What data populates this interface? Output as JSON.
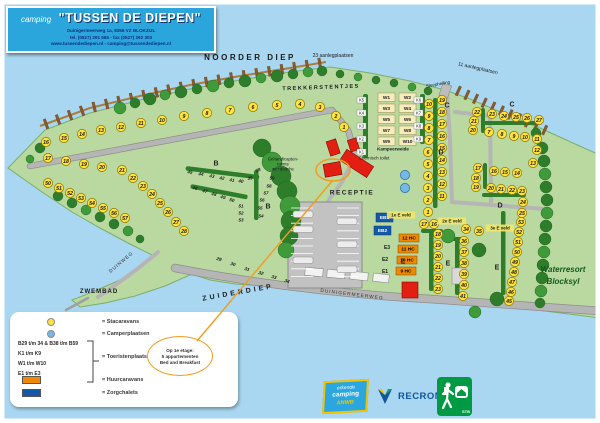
{
  "title": {
    "prefix": "camping",
    "name": "\"TUSSEN DE DIEPEN\"",
    "addr1": "Duinigermeerweg 1a, 8356 VZ BLOKZIJL",
    "addr2": "tel. (0527) 291 565 - fax (0527) 292 303",
    "addr3": "www.tussendediepen.nl - camping@tussendediepen.nl"
  },
  "legend": {
    "stacaravans": "= Stacaravans",
    "camperplaatsen": "= Camperplaatsen",
    "codes": [
      "B29 t/m 34 & B38 t/m B59",
      "K1 t/m K9",
      "W1 t/m W10",
      "E1 t/m E3"
    ],
    "toeristenplaatsen": "= Toeristenplaatsen",
    "huurcaravans": "= Huurcaravans",
    "zorgchalets": "= Zorgchalets"
  },
  "note": {
    "lines": [
      "Op 1e etage:",
      "5 appartementen",
      "Bed and Breakfast"
    ]
  },
  "logos": {
    "anwb_line1": "erkende",
    "anwb_line2": "camping",
    "anwb_line3": "ANWB",
    "recron": "RECRON",
    "stb": "STB"
  },
  "colors": {
    "water": "#a9d6f0",
    "land": "#b9d9a0",
    "tree": "#2e7d2b",
    "road": "#b5b5b5",
    "stacaravan": "#ffe23d",
    "camper": "#74b9e6",
    "huur": "#ef8a00",
    "zorg": "#1458a8",
    "building": "#e31f13",
    "accent": "#f29c1f",
    "brand": "#2ba6dd"
  },
  "map": {
    "jetties": {
      "count_west": 23,
      "count_east": 11
    },
    "labels": [
      {
        "n": "noorder-diep-label",
        "t": "NOORDER DIEP",
        "x": 250,
        "y": 57,
        "s": 8,
        "w": 700,
        "ls": 2.5
      },
      {
        "n": "aanlegplaatsen-23-label",
        "t": "23 aanlegplaatsen",
        "x": 333,
        "y": 55,
        "s": 5
      },
      {
        "n": "aanlegplaatsen-11-label",
        "t": "11 aanlegplaatsen",
        "x": 478,
        "y": 68,
        "s": 5,
        "r": 13
      },
      {
        "n": "trekkerstentjes-label",
        "t": "TREKKERSTENTJES",
        "x": 321,
        "y": 87,
        "s": 5.5,
        "w": 700,
        "ls": 1.5,
        "r": -2
      },
      {
        "n": "sleephelling-label",
        "t": "Sleephelling",
        "x": 438,
        "y": 84,
        "s": 4.5,
        "r": -10
      },
      {
        "n": "receptie-label",
        "t": "RECEPTIE",
        "x": 352,
        "y": 192,
        "s": 6.5,
        "w": 700,
        "ls": 1.5
      },
      {
        "n": "chemisch-toilet-label",
        "t": "Chemisch toilet",
        "x": 374,
        "y": 158,
        "s": 4.5
      },
      {
        "n": "gehandicapten-label-1",
        "t": "Gehandicapten-",
        "x": 283,
        "y": 159,
        "s": 4.3
      },
      {
        "n": "gehandicapten-label-2",
        "t": "ruimte",
        "x": 283,
        "y": 164,
        "s": 4.3
      },
      {
        "n": "gehandicapten-label-3",
        "t": "wc+douche",
        "x": 283,
        "y": 169,
        "s": 4.3
      },
      {
        "n": "kampeerweide-label",
        "t": "Kampeerweide",
        "x": 393,
        "y": 149,
        "s": 4.5,
        "w": 700
      },
      {
        "n": "zuiderdiep-label",
        "t": "ZUIDERDIEP",
        "x": 238,
        "y": 292,
        "s": 7,
        "w": 700,
        "ls": 3,
        "r": -10
      },
      {
        "n": "duinigermeerweg-label",
        "t": "DUINIGERMEERWEG",
        "x": 352,
        "y": 294,
        "s": 4.8,
        "ls": 1,
        "r": 7,
        "c": "#333333"
      },
      {
        "n": "duinweg-label",
        "t": "DUINWEG",
        "x": 121,
        "y": 262,
        "s": 4.8,
        "ls": 1,
        "r": -40,
        "c": "#333333"
      },
      {
        "n": "zwembad-label",
        "t": "ZWEMBAD",
        "x": 99,
        "y": 291,
        "s": 6,
        "w": 700,
        "ls": 1
      },
      {
        "n": "waterresort-label-1",
        "t": "Waterresort",
        "x": 563,
        "y": 269,
        "s": 8,
        "w": 700,
        "i": 1,
        "c": "#14591d"
      },
      {
        "n": "waterresort-label-2",
        "t": "Blocksyl",
        "x": 563,
        "y": 281,
        "s": 8,
        "w": 700,
        "i": 1,
        "c": "#14591d"
      },
      {
        "n": "area-b-label-1",
        "t": "B",
        "x": 216,
        "y": 163,
        "s": 7,
        "w": 700,
        "c": "#222222"
      },
      {
        "n": "area-b-label-2",
        "t": "B",
        "x": 268,
        "y": 206,
        "s": 7,
        "w": 700,
        "c": "#222222"
      },
      {
        "n": "area-c-label-1",
        "t": "C",
        "x": 447,
        "y": 105,
        "s": 7,
        "w": 700,
        "c": "#222222"
      },
      {
        "n": "area-c-label-2",
        "t": "C",
        "x": 512,
        "y": 104,
        "s": 7,
        "w": 700,
        "c": "#222222"
      },
      {
        "n": "area-d-label-1",
        "t": "D",
        "x": 441,
        "y": 152,
        "s": 7,
        "w": 700,
        "c": "#222222"
      },
      {
        "n": "area-d-label-2",
        "t": "D",
        "x": 500,
        "y": 205,
        "s": 7,
        "w": 700,
        "c": "#222222"
      },
      {
        "n": "area-e-label-1",
        "t": "E",
        "x": 403,
        "y": 261,
        "s": 7,
        "w": 700,
        "c": "#222222"
      },
      {
        "n": "area-e-label-2",
        "t": "E",
        "x": 448,
        "y": 263,
        "s": 7,
        "w": 700,
        "c": "#222222"
      },
      {
        "n": "area-e-label-3",
        "t": "E",
        "x": 497,
        "y": 267,
        "s": 7,
        "w": 700,
        "c": "#222222"
      },
      {
        "n": "e1-field-label",
        "t": "E1",
        "x": 385,
        "y": 271,
        "s": 5,
        "w": 700
      },
      {
        "n": "e2-field-label",
        "t": "E2",
        "x": 385,
        "y": 259,
        "s": 5,
        "w": 700
      },
      {
        "n": "e3-field-label",
        "t": "E3",
        "x": 387,
        "y": 247,
        "s": 5,
        "w": 700
      },
      {
        "n": "veld-1e-label",
        "t": "1e E veld",
        "x": 401,
        "y": 215,
        "s": 4.5,
        "w": 700,
        "bg": "#f3e768"
      },
      {
        "n": "veld-2e-label",
        "t": "2e E veld",
        "x": 452,
        "y": 221,
        "s": 4.5,
        "w": 700,
        "bg": "#f3e768"
      },
      {
        "n": "veld-3e-label",
        "t": "3e E veld",
        "x": 500,
        "y": 228,
        "s": 4.5,
        "w": 700,
        "bg": "#f3e768"
      }
    ],
    "circles": [
      [
        16,
        46,
        142
      ],
      [
        15,
        64,
        138
      ],
      [
        14,
        82,
        134
      ],
      [
        13,
        101,
        130
      ],
      [
        12,
        121,
        127
      ],
      [
        11,
        141,
        123
      ],
      [
        10,
        162,
        120
      ],
      [
        9,
        184,
        116
      ],
      [
        8,
        207,
        113
      ],
      [
        7,
        230,
        110
      ],
      [
        6,
        253,
        107
      ],
      [
        5,
        277,
        105
      ],
      [
        4,
        300,
        104
      ],
      [
        3,
        320,
        107
      ],
      [
        2,
        336,
        116
      ],
      [
        1,
        344,
        127
      ],
      [
        17,
        48,
        158
      ],
      [
        18,
        66,
        161
      ],
      [
        19,
        84,
        164
      ],
      [
        20,
        102,
        167
      ],
      [
        21,
        122,
        170
      ],
      [
        22,
        133,
        178
      ],
      [
        23,
        143,
        186
      ],
      [
        24,
        152,
        194
      ],
      [
        25,
        160,
        203
      ],
      [
        26,
        168,
        212
      ],
      [
        27,
        176,
        222
      ],
      [
        28,
        184,
        231
      ],
      [
        50,
        48,
        183
      ],
      [
        51,
        59,
        188
      ],
      [
        52,
        70,
        193
      ],
      [
        53,
        81,
        198
      ],
      [
        54,
        92,
        203
      ],
      [
        55,
        103,
        208
      ],
      [
        56,
        114,
        213
      ],
      [
        57,
        125,
        218
      ],
      [
        22,
        477,
        112
      ],
      [
        21,
        474,
        121
      ],
      [
        20,
        473,
        130
      ],
      [
        23,
        492,
        114
      ],
      [
        24,
        504,
        116
      ],
      [
        25,
        516,
        117
      ],
      [
        26,
        527,
        118
      ],
      [
        27,
        539,
        120
      ],
      [
        7,
        489,
        132
      ],
      [
        8,
        502,
        134
      ],
      [
        9,
        514,
        136
      ],
      [
        10,
        525,
        137
      ],
      [
        11,
        537,
        139
      ],
      [
        12,
        537,
        150
      ],
      [
        13,
        533,
        163
      ],
      [
        17,
        478,
        168
      ],
      [
        16,
        494,
        171
      ],
      [
        15,
        505,
        172
      ],
      [
        14,
        517,
        173
      ],
      [
        18,
        476,
        178
      ],
      [
        19,
        476,
        187
      ],
      [
        20,
        491,
        188
      ],
      [
        21,
        501,
        189
      ],
      [
        22,
        512,
        190
      ],
      [
        23,
        522,
        191
      ],
      [
        24,
        523,
        202
      ],
      [
        25,
        522,
        213
      ],
      [
        10,
        429,
        104
      ],
      [
        9,
        429,
        116
      ],
      [
        8,
        429,
        128
      ],
      [
        7,
        429,
        140
      ],
      [
        6,
        428,
        152
      ],
      [
        5,
        428,
        164
      ],
      [
        4,
        428,
        176
      ],
      [
        3,
        428,
        188
      ],
      [
        2,
        428,
        200
      ],
      [
        1,
        428,
        212
      ],
      [
        19,
        442,
        100
      ],
      [
        18,
        442,
        112
      ],
      [
        17,
        442,
        124
      ],
      [
        16,
        442,
        136
      ],
      [
        15,
        442,
        148
      ],
      [
        14,
        442,
        160
      ],
      [
        13,
        442,
        172
      ],
      [
        12,
        442,
        184
      ],
      [
        11,
        442,
        196
      ],
      [
        17,
        424,
        224
      ],
      [
        16,
        434,
        224
      ],
      [
        18,
        438,
        234
      ],
      [
        19,
        438,
        245
      ],
      [
        20,
        438,
        256
      ],
      [
        21,
        438,
        267
      ],
      [
        22,
        438,
        278
      ],
      [
        23,
        438,
        289
      ],
      [
        34,
        466,
        229
      ],
      [
        35,
        479,
        231
      ],
      [
        36,
        464,
        241
      ],
      [
        37,
        464,
        252
      ],
      [
        38,
        464,
        263
      ],
      [
        39,
        464,
        274
      ],
      [
        40,
        464,
        285
      ],
      [
        41,
        463,
        296
      ],
      [
        53,
        521,
        222
      ],
      [
        52,
        519,
        232
      ],
      [
        51,
        518,
        242
      ],
      [
        50,
        517,
        252
      ],
      [
        49,
        515,
        262
      ],
      [
        48,
        514,
        272
      ],
      [
        47,
        512,
        282
      ],
      [
        46,
        511,
        292
      ],
      [
        45,
        509,
        301
      ]
    ],
    "blue_circles": [
      [
        405,
        175
      ],
      [
        405,
        188
      ]
    ],
    "nums": [
      [
        29,
        219,
        259,
        18
      ],
      [
        30,
        233,
        264,
        18
      ],
      [
        31,
        247,
        269,
        18
      ],
      [
        32,
        261,
        273,
        18
      ],
      [
        33,
        274,
        277,
        18
      ],
      [
        34,
        287,
        281,
        18
      ],
      [
        45,
        190,
        172,
        8
      ],
      [
        44,
        201,
        174,
        8
      ],
      [
        43,
        212,
        176,
        8
      ],
      [
        42,
        222,
        178,
        8
      ],
      [
        41,
        232,
        180,
        8
      ],
      [
        40,
        241,
        181,
        8
      ],
      [
        39,
        250,
        178,
        -10
      ],
      [
        38,
        258,
        170,
        -20
      ],
      [
        46,
        195,
        188,
        12
      ],
      [
        47,
        205,
        191,
        12
      ],
      [
        48,
        214,
        194,
        12
      ],
      [
        49,
        223,
        197,
        12
      ],
      [
        50,
        232,
        200,
        12
      ],
      [
        51,
        241,
        206,
        0
      ],
      [
        52,
        241,
        213,
        0
      ],
      [
        53,
        241,
        220,
        0
      ],
      [
        59,
        272,
        178,
        0
      ],
      [
        58,
        269,
        186,
        0
      ],
      [
        57,
        266,
        193,
        0
      ],
      [
        56,
        262,
        200,
        0
      ],
      [
        55,
        260,
        208,
        0
      ],
      [
        54,
        261,
        216,
        0
      ]
    ],
    "w_squares": [
      [
        "W1",
        378,
        93
      ],
      [
        "W2",
        399,
        93
      ],
      [
        "W3",
        378,
        104
      ],
      [
        "W4",
        399,
        104
      ],
      [
        "W5",
        378,
        115
      ],
      [
        "W6",
        399,
        115
      ],
      [
        "W7",
        378,
        126
      ],
      [
        "W8",
        399,
        126
      ],
      [
        "W9",
        378,
        137
      ],
      [
        "W10",
        399,
        137
      ]
    ],
    "k_labels": [
      [
        "K5",
        357,
        97
      ],
      [
        "K4",
        357,
        110
      ],
      [
        "K3",
        357,
        123
      ],
      [
        "K2",
        357,
        136
      ],
      [
        "K1",
        357,
        149
      ],
      [
        "K6",
        414,
        97
      ],
      [
        "K7",
        414,
        110
      ],
      [
        "K8",
        414,
        123
      ],
      [
        "K9",
        414,
        136
      ]
    ],
    "hc_rects": [
      [
        "12 HC",
        399,
        234
      ],
      [
        "11 HC",
        398,
        245
      ],
      [
        "10 HC",
        397,
        256
      ],
      [
        "9 HC",
        396,
        267
      ]
    ],
    "zb_rects": [
      [
        "EB1",
        376,
        213
      ],
      [
        "EB2",
        374,
        226
      ]
    ]
  }
}
